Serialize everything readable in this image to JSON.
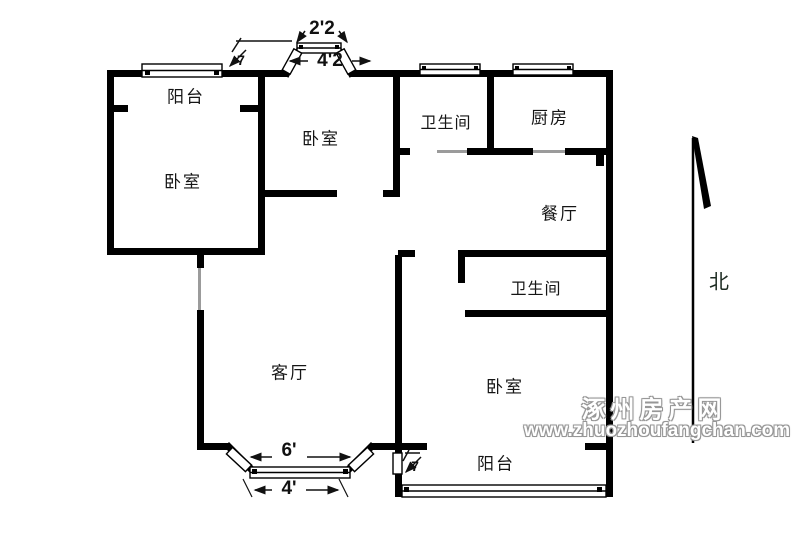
{
  "title": "apartment-floor-plan",
  "rooms": [
    {
      "id": "balcony-top",
      "label": "阳台"
    },
    {
      "id": "bedroom-left",
      "label": "卧室"
    },
    {
      "id": "bedroom-middle",
      "label": "卧室"
    },
    {
      "id": "bathroom-top",
      "label": "卫生间"
    },
    {
      "id": "kitchen",
      "label": "厨房"
    },
    {
      "id": "dining-room",
      "label": "餐厅"
    },
    {
      "id": "bathroom-middle",
      "label": "卫生间"
    },
    {
      "id": "living-room",
      "label": "客厅"
    },
    {
      "id": "bedroom-right",
      "label": "卧室"
    },
    {
      "id": "balcony-bottom",
      "label": "阳台"
    }
  ],
  "dimensions": [
    {
      "id": "bay-top-inner",
      "label": "2'2"
    },
    {
      "id": "bay-top-outer",
      "label": "4'2"
    },
    {
      "id": "bay-bottom-outer",
      "label": "6'"
    },
    {
      "id": "bay-bottom-inner",
      "label": "4'"
    },
    {
      "id": "mark-top-left",
      "label": "7"
    },
    {
      "id": "mark-bottom-mid",
      "label": "7"
    }
  ],
  "compass": {
    "label": "北"
  },
  "watermark": {
    "line1": "涿州房产网",
    "line2": "www.zhuozhoufangchan.com",
    "color": "#969696"
  },
  "colors": {
    "wall": "#000000",
    "door_opening_line": "#9b9b9b",
    "background": "#ffffff",
    "text": "#151515"
  }
}
